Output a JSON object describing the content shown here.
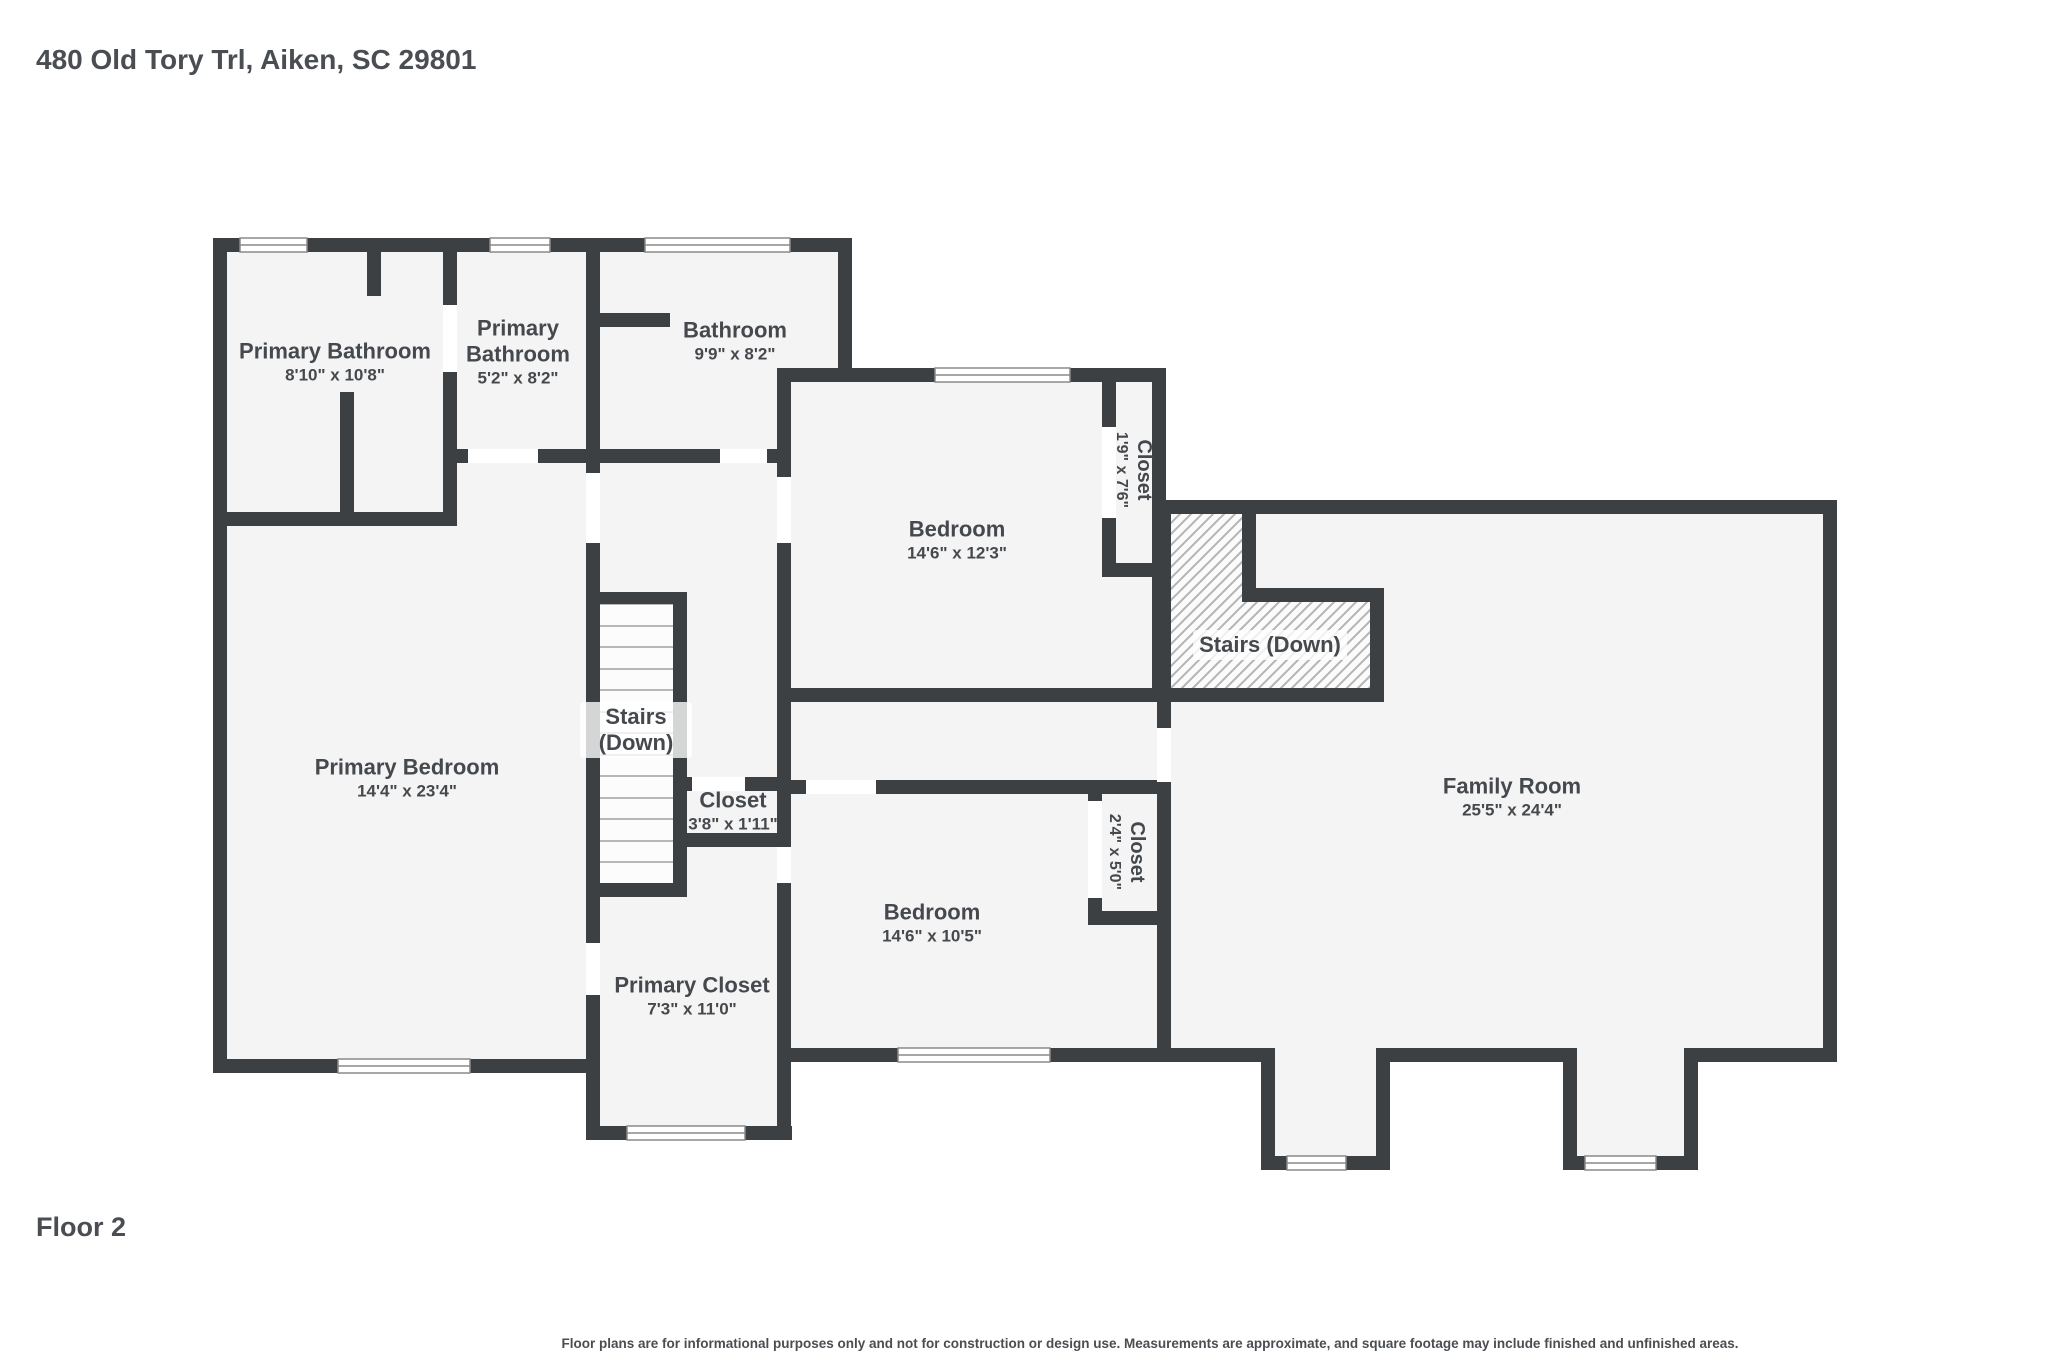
{
  "header": {
    "title": "480 Old Tory Trl, Aiken, SC 29801"
  },
  "footer": {
    "floor_label": "Floor 2",
    "disclaimer": "Floor plans are for informational purposes only and not for construction or design use. Measurements are approximate, and square footage may include finished and unfinished areas."
  },
  "colors": {
    "wall": "#3c4043",
    "floor": "#f4f4f4",
    "hatch_line": "#b4b4b4",
    "tread_line": "#b7b7b7",
    "text": "#45494d",
    "door_gap": "#ffffff"
  },
  "rooms": {
    "primary_bathroom_1": {
      "name": "Primary Bathroom",
      "dims": "8'10\" x 10'8\""
    },
    "primary_bathroom_2": {
      "name": "Primary Bathroom",
      "dims": "5'2\" x 8'2\""
    },
    "bathroom": {
      "name": "Bathroom",
      "dims": "9'9\" x 8'2\""
    },
    "bedroom_upper": {
      "name": "Bedroom",
      "dims": "14'6\" x 12'3\""
    },
    "closet_upper": {
      "name": "Closet",
      "dims": "1'9\" x 7'6\""
    },
    "stairs_family": {
      "name": "Stairs (Down)"
    },
    "family_room": {
      "name": "Family Room",
      "dims": "25'5\" x 24'4\""
    },
    "primary_bedroom": {
      "name": "Primary Bedroom",
      "dims": "14'4\" x 23'4\""
    },
    "stairs_center": {
      "name": "Stairs (Down)"
    },
    "closet_hall": {
      "name": "Closet",
      "dims": "3'8\" x 1'11\""
    },
    "bedroom_lower": {
      "name": "Bedroom",
      "dims": "14'6\" x 10'5\""
    },
    "closet_lower": {
      "name": "Closet",
      "dims": "2'4\" x 5'0\""
    },
    "primary_closet": {
      "name": "Primary Closet",
      "dims": "7'3\" x 11'0\""
    }
  }
}
